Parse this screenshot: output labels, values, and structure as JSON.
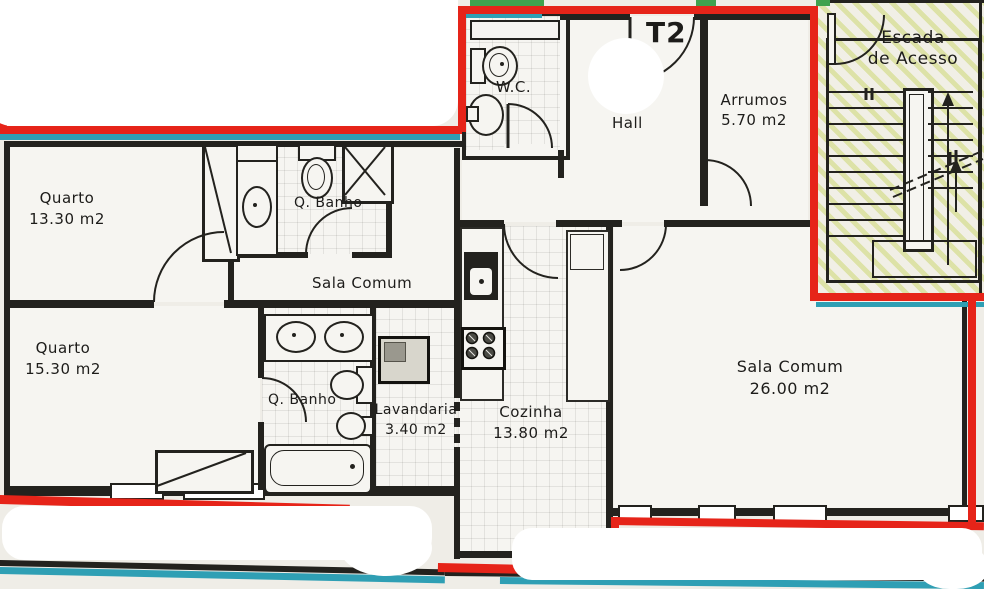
{
  "plan": {
    "type_badge": "T2",
    "stairwell": {
      "label_line1": "Escada",
      "label_line2": "de Acesso"
    },
    "rooms": [
      {
        "id": "arrumos",
        "name": "Arrumos",
        "area": "5.70 m2"
      },
      {
        "id": "hall",
        "name": "Hall",
        "area": ""
      },
      {
        "id": "wc",
        "name": "W.C.",
        "area": ""
      },
      {
        "id": "quarto-1",
        "name": "Quarto",
        "area": "13.30 m2"
      },
      {
        "id": "q-banho-1",
        "name": "Q. Banho",
        "area": ""
      },
      {
        "id": "sala-mid",
        "name": "Sala Comum",
        "area": ""
      },
      {
        "id": "quarto-2",
        "name": "Quarto",
        "area": "15.30 m2"
      },
      {
        "id": "q-banho-2",
        "name": "Q. Banho",
        "area": ""
      },
      {
        "id": "lavandaria",
        "name": "Lavandaria",
        "area": "3.40 m2"
      },
      {
        "id": "cozinha",
        "name": "Cozinha",
        "area": "13.80 m2"
      },
      {
        "id": "sala",
        "name": "Sala Comum",
        "area": "26.00 m2"
      }
    ],
    "colors": {
      "boundary_red": "#e62419",
      "boundary_teal": "#2f9fb4",
      "accent_green": "#3fa24e",
      "wall": "#23221e",
      "stair_hatch": "#c4d25a"
    }
  }
}
